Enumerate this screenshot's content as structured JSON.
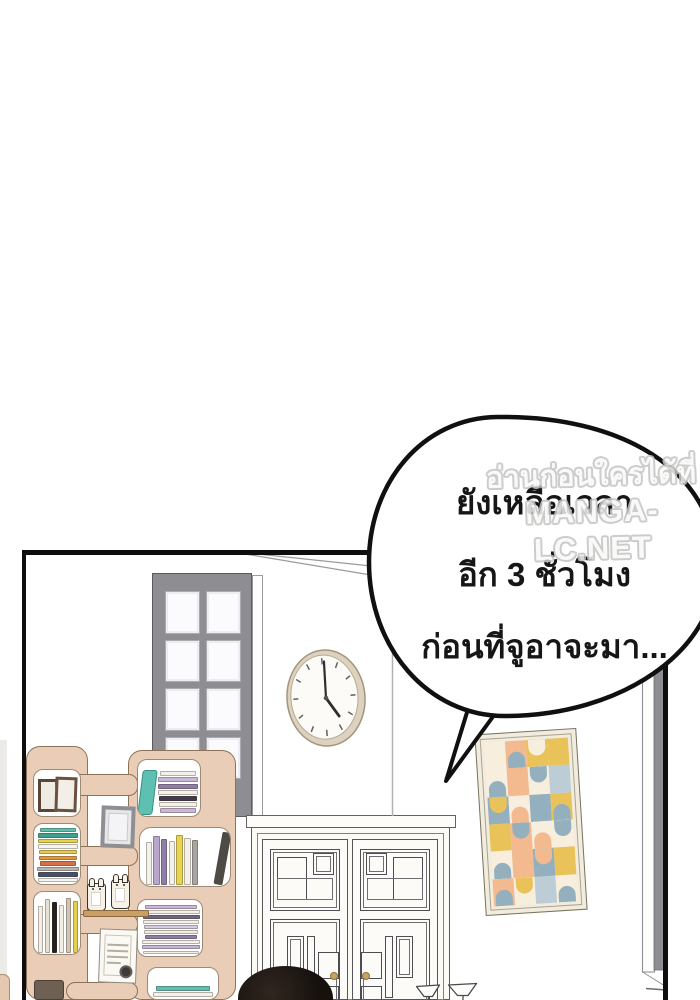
{
  "speech_bubble": {
    "lines": [
      "ยังเหลือเวลา",
      "อีก 3 ชั่วโมง",
      "ก่อนที่จูอาจะมา..."
    ]
  },
  "watermark": {
    "line1": "อ่านก่อนใครได้ที่",
    "line2": "MANGA-LC.NET"
  },
  "clock": {
    "minute_angle_deg": 4,
    "hour_angle_deg": 140
  },
  "palette": {
    "ink": "#0e0e0e",
    "shelf_beige": "#e9cdb6",
    "shelf_outline": "#8d7257",
    "door_gray": "#8d8d92",
    "knob_gold": "#c9a362",
    "ledge_wood": "#c99f66",
    "hair_black": "#17110d",
    "watermark_gray": "#c4c4c4",
    "clock_rim": "#dcd2bf",
    "wall_white": "#ffffff"
  },
  "art": {
    "palette": {
      "peach": "#f3b98f",
      "blue": "#94afbe",
      "mustard": "#e9c35a",
      "cream": "#f7eede",
      "softblue": "#bccdd6",
      "frame": "#f1ecdd"
    },
    "tiles": [
      {
        "bg": "cream",
        "fg": null,
        "shape": null
      },
      {
        "bg": "peach",
        "fg": "blue",
        "shape": "up"
      },
      {
        "bg": "mustard",
        "fg": "cream",
        "shape": "down"
      },
      {
        "bg": "mustard",
        "fg": null,
        "shape": null
      },
      {
        "bg": "cream",
        "fg": "blue",
        "shape": "up"
      },
      {
        "bg": "peach",
        "fg": null,
        "shape": null
      },
      {
        "bg": "cream",
        "fg": "blue",
        "shape": "down"
      },
      {
        "bg": "softblue",
        "fg": null,
        "shape": null
      },
      {
        "bg": "blue",
        "fg": "mustard",
        "shape": "down"
      },
      {
        "bg": "cream",
        "fg": "peach",
        "shape": "up"
      },
      {
        "bg": "blue",
        "fg": null,
        "shape": null
      },
      {
        "bg": "mustard",
        "fg": "blue",
        "shape": "up"
      },
      {
        "bg": "mustard",
        "fg": null,
        "shape": null
      },
      {
        "bg": "peach",
        "fg": "blue",
        "shape": "down"
      },
      {
        "bg": "cream",
        "fg": "peach",
        "shape": "up"
      },
      {
        "bg": "cream",
        "fg": "blue",
        "shape": "down"
      },
      {
        "bg": "cream",
        "fg": "blue",
        "shape": "up"
      },
      {
        "bg": "peach",
        "fg": null,
        "shape": null
      },
      {
        "bg": "blue",
        "fg": "peach",
        "shape": "down"
      },
      {
        "bg": "mustard",
        "fg": null,
        "shape": null
      },
      {
        "bg": "peach",
        "fg": "blue",
        "shape": "up"
      },
      {
        "bg": "cream",
        "fg": "mustard",
        "shape": "down"
      },
      {
        "bg": "softblue",
        "fg": null,
        "shape": null
      },
      {
        "bg": "cream",
        "fg": "blue",
        "shape": "up"
      }
    ]
  },
  "books": {
    "left_horizontal": [
      "#5fc0ae",
      "#3fa08e",
      "#e6d34b",
      "#f6f4ef",
      "#e9c94f",
      "#e39a3b",
      "#d96f45",
      "#b9b4ac",
      "#47506b",
      "#f6f4ef"
    ],
    "left_vertical": [
      "#f3efe6",
      "#e8e0d0",
      "#23201d",
      "#f3efe6",
      "#cfc6b5",
      "#e8cf4a"
    ],
    "right_top_stack": [
      "#f4f1ea",
      "#cbb8d9",
      "#8e7fa8",
      "#f4f1ea",
      "#3f3b4a",
      "#f4f1ea",
      "#cbb8d9"
    ],
    "right_vertical": [
      "#f4f1ea",
      "#b9a6cc",
      "#8e7fa8",
      "#f4f1ea",
      "#e8d44e",
      "#f4f1ea",
      "#a9a5a0"
    ],
    "right_mid_stack": [
      "#cbb8d9",
      "#f4f1ea",
      "#6e6880",
      "#f4f1ea",
      "#d8cbe4",
      "#efece4",
      "#8e7fa8",
      "#f4f1ea",
      "#c4b6d6",
      "#f4f1ea"
    ],
    "right_bottom": [
      "#5ec0b2",
      "#f4f1ea"
    ]
  }
}
